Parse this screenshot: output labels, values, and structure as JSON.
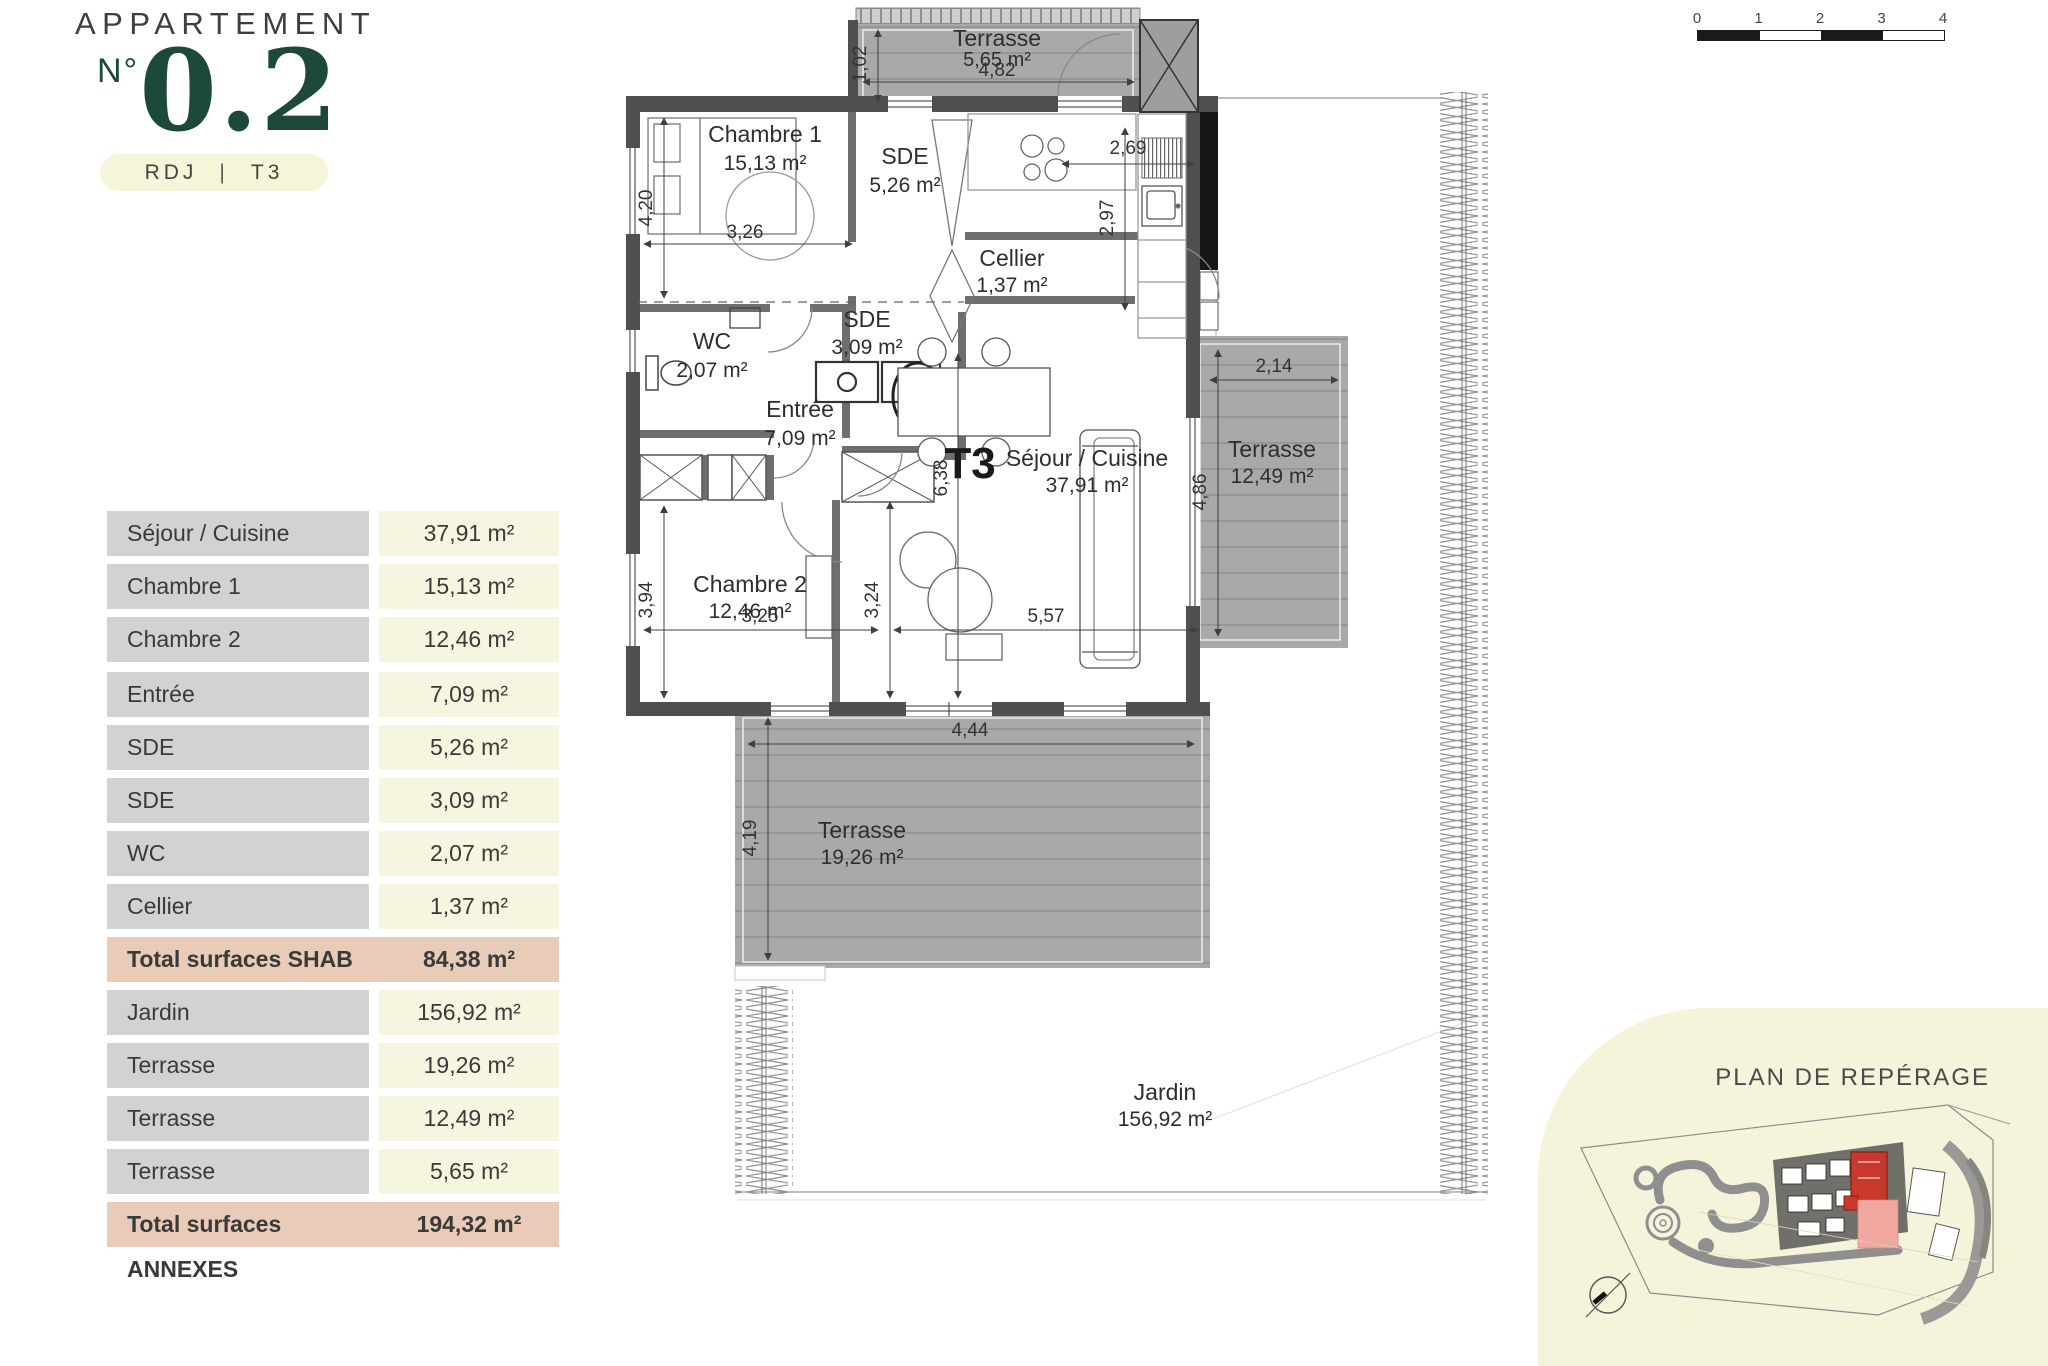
{
  "header": {
    "title": "APPARTEMENT",
    "number_prefix": "N°",
    "number": "0.2",
    "badge_left": "RDJ",
    "badge_sep": "|",
    "badge_right": "T3"
  },
  "table": {
    "rows": [
      {
        "label": "Séjour / Cuisine",
        "value": "37,91 m²"
      },
      {
        "label": "Chambre 1",
        "value": "15,13 m²"
      },
      {
        "label": "Chambre 2",
        "value": "12,46 m²"
      },
      {
        "label": "Entrée",
        "value": "7,09 m²"
      },
      {
        "label": "SDE",
        "value": "5,26 m²"
      },
      {
        "label": "SDE",
        "value": "3,09 m²"
      },
      {
        "label": "WC",
        "value": "2,07 m²"
      },
      {
        "label": "Cellier",
        "value": "1,37 m²"
      }
    ],
    "total_shab": {
      "label": "Total surfaces SHAB",
      "value": "84,38 m²"
    },
    "annex_rows": [
      {
        "label": "Jardin",
        "value": "156,92 m²"
      },
      {
        "label": "Terrasse",
        "value": "19,26 m²"
      },
      {
        "label": "Terrasse",
        "value": "12,49 m²"
      },
      {
        "label": "Terrasse",
        "value": "5,65 m²"
      }
    ],
    "total_annexes": {
      "label": "Total surfaces ANNEXES",
      "value": "194,32 m²"
    }
  },
  "plan": {
    "unit_label": "T3",
    "rooms": {
      "ch1": {
        "name": "Chambre 1",
        "area": "15,13 m²"
      },
      "sde1": {
        "name": "SDE",
        "area": "5,26 m²"
      },
      "cellier": {
        "name": "Cellier",
        "area": "1,37 m²"
      },
      "wc": {
        "name": "WC",
        "area": "2,07 m²"
      },
      "sde2": {
        "name": "SDE",
        "area": "3,09 m²"
      },
      "entree": {
        "name": "Entrée",
        "area": "7,09 m²"
      },
      "sejour": {
        "name": "Séjour / Cuisine",
        "area": "37,91 m²"
      },
      "ch2": {
        "name": "Chambre 2",
        "area": "12,46 m²"
      },
      "t_haut": {
        "name": "Terrasse",
        "area": "5,65 m²"
      },
      "t_droite": {
        "name": "Terrasse",
        "area": "12,49 m²"
      },
      "t_bas": {
        "name": "Terrasse",
        "area": "19,26 m²"
      },
      "jardin": {
        "name": "Jardin",
        "area": "156,92 m²"
      }
    },
    "dims": {
      "t_haut_l": "4,82",
      "t_haut_w": "1,02",
      "ch1_h": "4,20",
      "ch1_w": "3,26",
      "cuis_w": "2,69",
      "cuis_h": "2,97",
      "t_dr_w": "2,14",
      "t_dr_h": "4,86",
      "sej_h": "6,38",
      "mid_h": "3,24",
      "ch2_h": "3,94",
      "ch2_w": "3,25",
      "sej_w": "5,57",
      "t_bas_w": "4,44",
      "t_bas_h": "4,19"
    }
  },
  "scalebar": {
    "labels": [
      "0",
      "1",
      "2",
      "3",
      "4"
    ]
  },
  "reperage": {
    "title": "PLAN DE REPÉRAGE"
  },
  "colors": {
    "accent_green": "#1d4a38",
    "badge_cream": "#f7f5d9",
    "table_gray": "#d2d2d0",
    "table_cream": "#f6f5df",
    "total_salmon": "#e8ccb8",
    "wall_dark": "#4f4f4f",
    "deck_gray": "#a9a9a9",
    "unit_red": "#c8382c",
    "reperage_cream": "#f5f3da"
  }
}
